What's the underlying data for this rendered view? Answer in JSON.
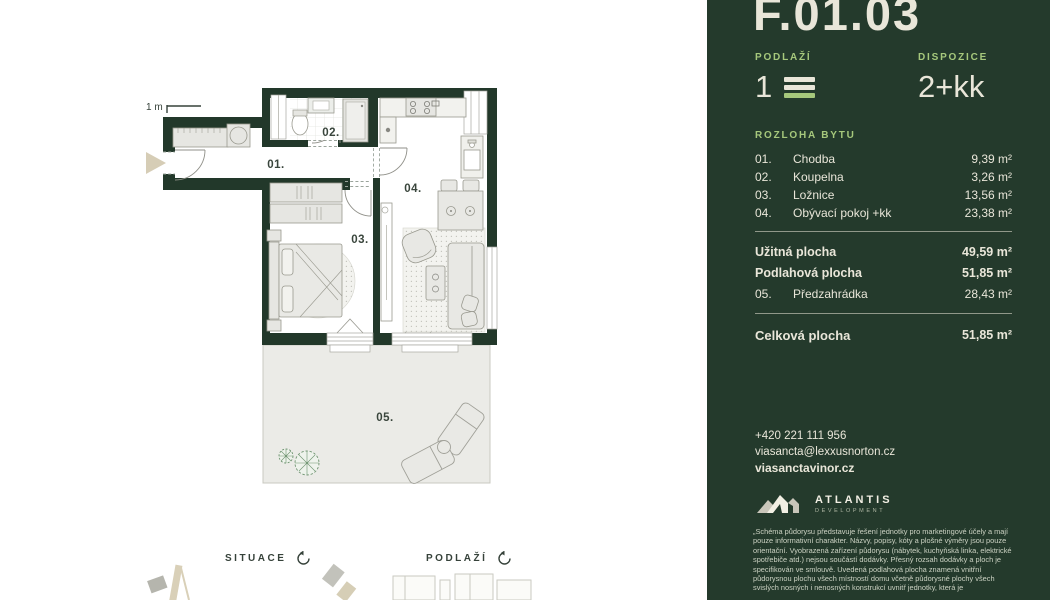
{
  "colors": {
    "sidebar_bg": "#243a2c",
    "wall_green": "#22382a",
    "accent_green": "#a6c87c",
    "cream": "#e9e6d9",
    "furniture_fill": "#e6e6e2",
    "terrace_fill": "#ebebe7"
  },
  "plan": {
    "scale_label": "1 m",
    "room_labels": {
      "r01": "01.",
      "r02": "02.",
      "r03": "03.",
      "r04": "04.",
      "r05": "05."
    },
    "icons": {
      "entrance_arrow": "entrance-arrow",
      "rotate_icon": "rotate-arrow"
    }
  },
  "footer": {
    "situace_label": "SITUACE",
    "podlazi_label": "PODLAŽÍ"
  },
  "sidebar": {
    "unit_id": "F.01.03",
    "floor": {
      "label": "PODLAŽÍ",
      "value": "1",
      "icon": "stacked-floor-bars"
    },
    "layout": {
      "label": "DISPOZICE",
      "value": "2+kk"
    },
    "area_table": {
      "heading": "ROZLOHA BYTU",
      "rooms": [
        {
          "num": "01.",
          "name": "Chodba",
          "area": "9,39 m²"
        },
        {
          "num": "02.",
          "name": "Koupelna",
          "area": "3,26 m²"
        },
        {
          "num": "03.",
          "name": "Ložnice",
          "area": "13,56 m²"
        },
        {
          "num": "04.",
          "name": "Obývací pokoj +kk",
          "area": "23,38 m²"
        }
      ],
      "summary": [
        {
          "num": "",
          "name": "Užitná plocha",
          "area": "49,59 m²"
        },
        {
          "num": "",
          "name": "Podlahová plocha",
          "area": "51,85 m²"
        },
        {
          "num": "05.",
          "name": "Předzahrádka",
          "area": "28,43 m²"
        }
      ],
      "total": {
        "name": "Celková plocha",
        "area": "51,85 m²"
      }
    },
    "contact": {
      "phone": "+420 221 111 956",
      "email": "viasancta@lexxusnorton.cz",
      "web": "viasanctavinor.cz"
    },
    "logo": {
      "name": "ATLANTIS",
      "sub": "DEVELOPMENT",
      "icon": "mountain-logo"
    },
    "disclaimer": "„Schéma půdorysu představuje řešení jednotky pro marketingové účely a mají pouze informativní charakter. Názvy, popisy, kóty a plošné výměry jsou pouze orientační. Vyobrazená zařízení půdorysu (nábytek, kuchyňská linka, elektrické spotřebiče atd.) nejsou součástí dodávky. Přesný rozsah dodávky a ploch je specifikován ve smlouvě. Uvedená podlahová plocha znamená vnitřní půdorysnou plochu všech místností domu včetně půdorysné plochy všech svislých nosných i nenosných konstrukcí uvnitř jednotky, která je"
  }
}
